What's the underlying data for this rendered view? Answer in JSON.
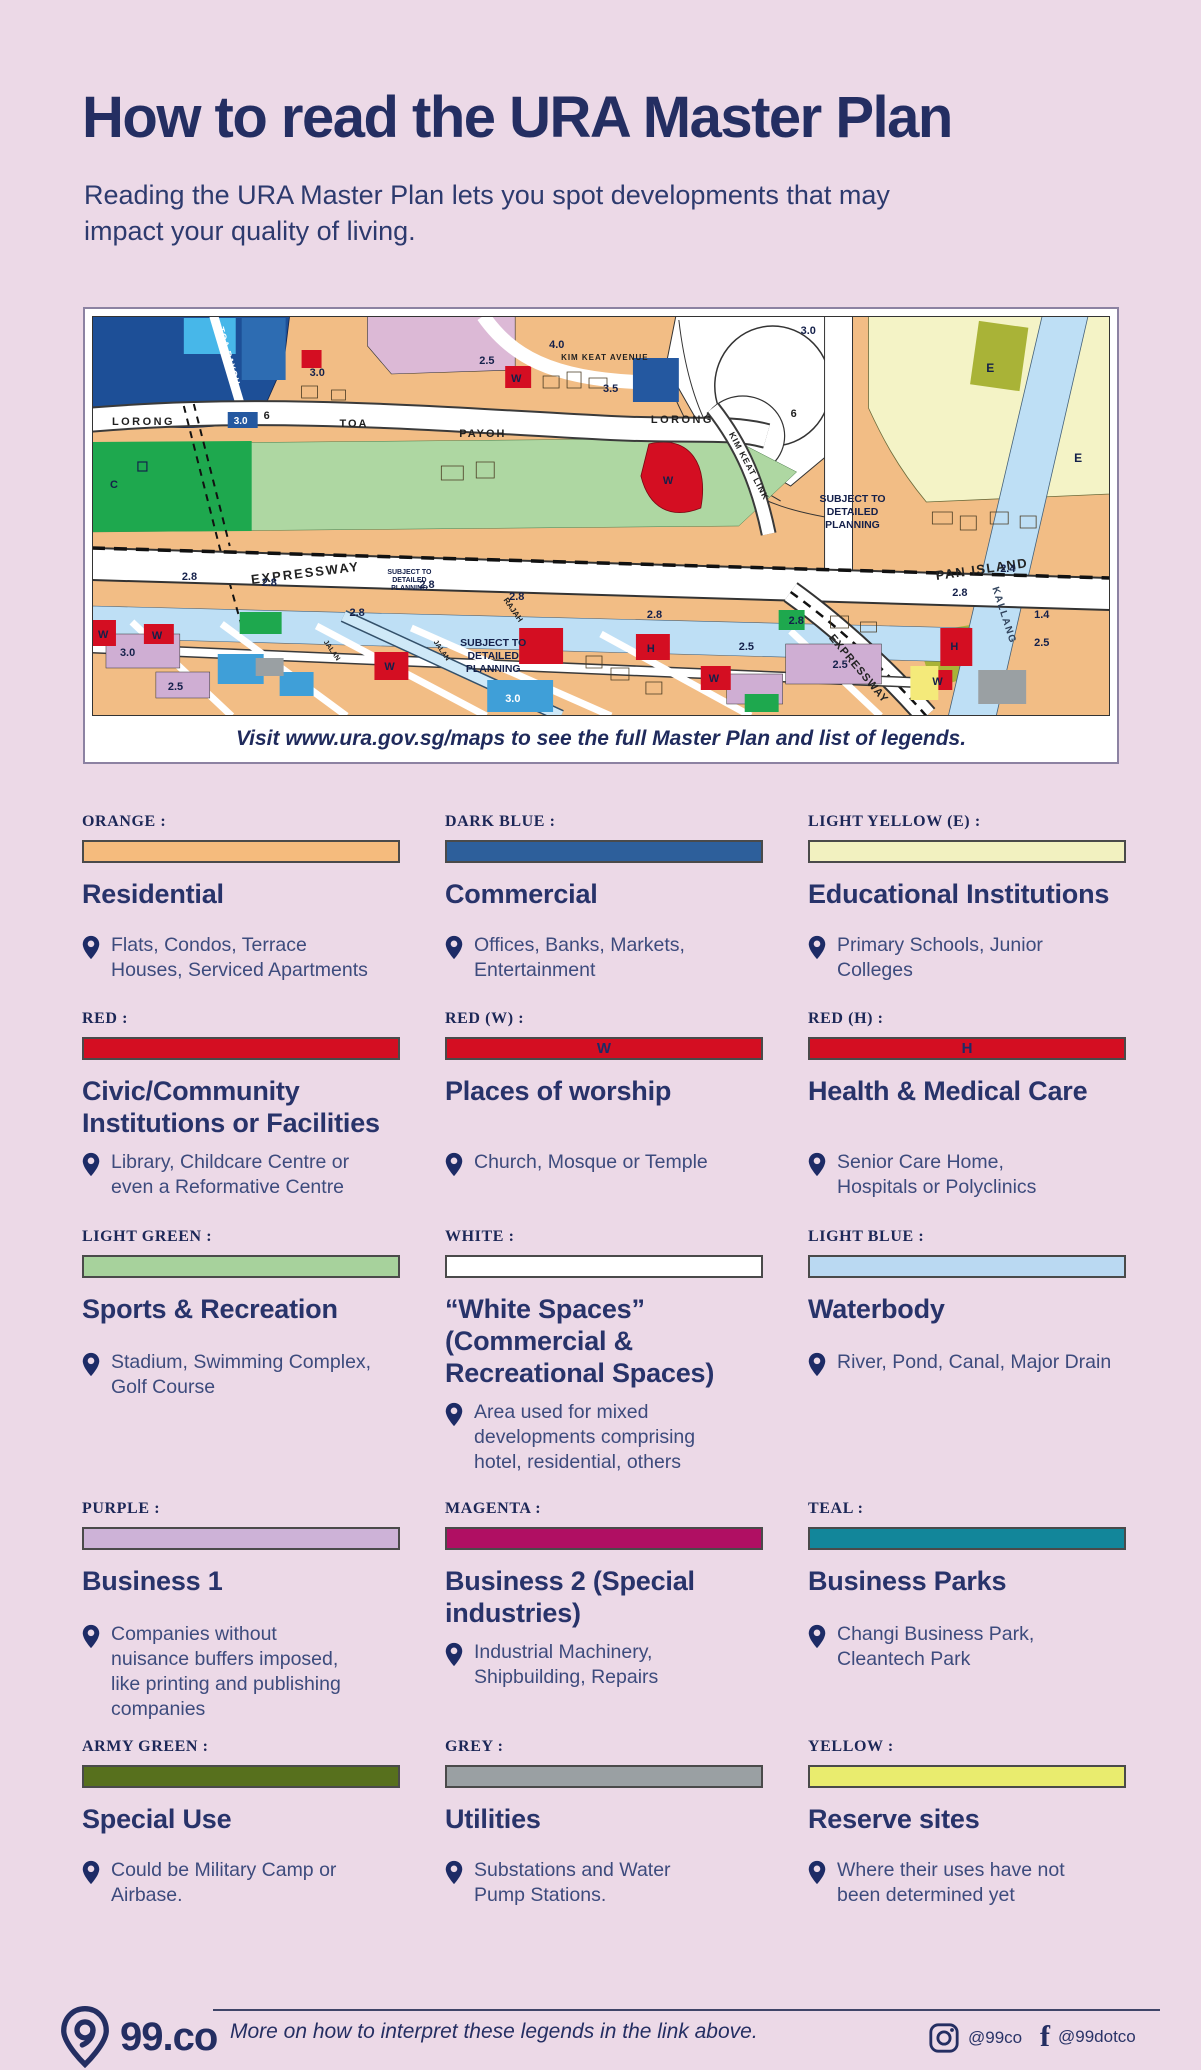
{
  "page": {
    "title": "How to read the URA Master Plan",
    "subtitle": "Reading the URA Master Plan lets you spot developments that may impact your quality of living.",
    "background": "#ecd9e7",
    "navy": "#242e62"
  },
  "map": {
    "caption": "Visit www.ura.gov.sg/maps to see the full Master Plan and list of legends.",
    "labels": {
      "lorong": "LORONG",
      "six": "6",
      "toa": "TOA",
      "payoh": "PAYOH",
      "toa_payoh": "TOA PAYOH",
      "kim_keat_avenue": "KIM KEAT AVENUE",
      "kim_keat_link": "KIM KEAT LINK",
      "expressway": "EXPRESSWAY",
      "pan_island": "PAN ISLAND",
      "kallang": "KALLANG",
      "rajah": "RAJAH",
      "jalan": "JALAN",
      "subject_line1": "SUBJECT TO",
      "subject_line2": "DETAILED",
      "subject_line3": "PLANNING"
    },
    "numbers": {
      "n14": "1.4",
      "n24": "2.4",
      "n25": "2.5",
      "n28": "2.8",
      "n30": "3.0",
      "n35": "3.5",
      "n40": "4.0"
    },
    "letters": {
      "w": "W",
      "h": "H",
      "e": "E",
      "c": "C"
    }
  },
  "legend": {
    "items": [
      {
        "color_label": "ORANGE :",
        "color": "#f5bb7d",
        "letter": "",
        "title": "Residential",
        "desc": "Flats, Condos, Terrace\nHouses, Serviced Apartments"
      },
      {
        "color_label": "DARK BLUE :",
        "color": "#2d5f9b",
        "letter": "",
        "title": "Commercial",
        "desc": "Offices, Banks, Markets,\nEntertainment"
      },
      {
        "color_label": "LIGHT YELLOW (E) :",
        "color": "#f2f1c0",
        "letter": "",
        "title": "Educational Institutions",
        "desc": "Primary Schools, Junior\nColleges"
      },
      {
        "color_label": "RED :",
        "color": "#d40e22",
        "letter": "",
        "title": "Civic/Community\nInstitutions or Facilities",
        "desc": "Library, Childcare Centre or\neven a Reformative Centre"
      },
      {
        "color_label": "RED (W) :",
        "color": "#d40e22",
        "letter": "W",
        "title": "Places of worship",
        "desc": "Church, Mosque or Temple"
      },
      {
        "color_label": "RED (H) :",
        "color": "#d40e22",
        "letter": "H",
        "title": "Health & Medical Care",
        "desc": "Senior Care Home,\nHospitals or Polyclinics"
      },
      {
        "color_label": "LIGHT GREEN :",
        "color": "#a7d29c",
        "letter": "",
        "title": "Sports &  Recreation",
        "desc": "Stadium, Swimming Complex,\nGolf Course"
      },
      {
        "color_label": "WHITE :",
        "color": "#ffffff",
        "letter": "",
        "title": "“White Spaces”\n(Commercial &\nRecreational Spaces)",
        "desc": "Area used for mixed\ndevelopments comprising\nhotel, residential, others"
      },
      {
        "color_label": "LIGHT BLUE :",
        "color": "#bad9f2",
        "letter": "",
        "title": "Waterbody",
        "desc": "River, Pond, Canal, Major Drain"
      },
      {
        "color_label": "PURPLE :",
        "color": "#cdb2d7",
        "letter": "",
        "title": "Business 1",
        "desc": "Companies without\nnuisance buffers imposed,\nlike printing and publishing\ncompanies"
      },
      {
        "color_label": "MAGENTA :",
        "color": "#b00f63",
        "letter": "",
        "title": "Business 2 (Special\nindustries)",
        "desc": "Industrial Machinery,\nShipbuilding, Repairs"
      },
      {
        "color_label": "TEAL :",
        "color": "#12869a",
        "letter": "",
        "title": "Business Parks",
        "desc": "Changi Business Park,\nCleantech Park"
      },
      {
        "color_label": "ARMY GREEN :",
        "color": "#57701d",
        "letter": "",
        "title": "Special Use",
        "desc": "Could be Military Camp or\nAirbase."
      },
      {
        "color_label": "GREY :",
        "color": "#9aa0a3",
        "letter": "",
        "title": "Utilities",
        "desc": "Substations and Water\nPump Stations."
      },
      {
        "color_label": "YELLOW :",
        "color": "#e9ec6e",
        "letter": "",
        "title": "Reserve sites",
        "desc": "Where their uses have not\nbeen determined yet"
      }
    ]
  },
  "footer": {
    "brand": "99.co",
    "note": "More on how to interpret these legends in the link above.",
    "instagram_handle": "@99co",
    "facebook_handle": "@99dotco"
  }
}
